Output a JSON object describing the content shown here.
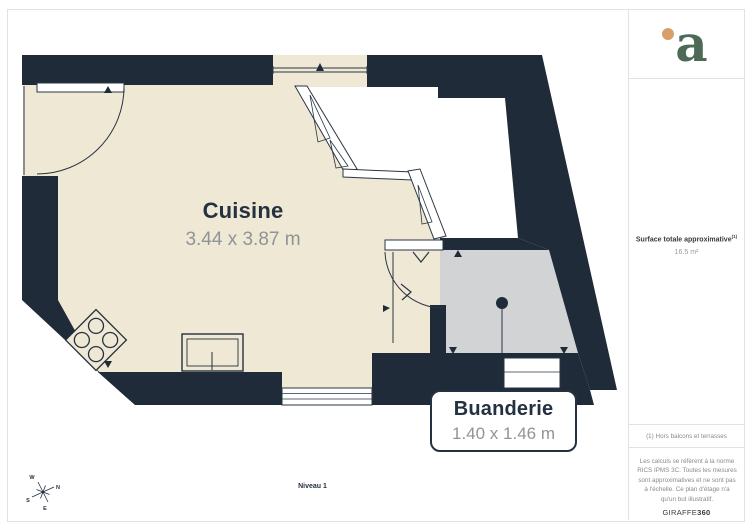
{
  "plan": {
    "rooms": [
      {
        "name": "Cuisine",
        "dimensions": "3.44 x 3.87 m"
      },
      {
        "name": "Buanderie",
        "dimensions": "1.40 x 1.46 m"
      }
    ],
    "level_label": "Niveau 1",
    "compass": {
      "north": "N",
      "south": "S",
      "east": "E",
      "west": "W"
    }
  },
  "sidebar": {
    "logo_letter": "a",
    "surface_label": "Surface totale approximative",
    "surface_footnote_marker": "(1)",
    "surface_value": "16.5 m²",
    "footnote": "(1) Hors balcons et terrasses",
    "disclaimer": "Les calculs se réfèrent à la norme RICS IPMS 3C. Toutes les mesures sont approximatives et ne sont pas à l'échelle. Ce plan d'étage n'a qu'un but illustratif.",
    "brand_name": "GIRAFFE",
    "brand_suffix": "360"
  },
  "colors": {
    "wall": "#1f2b38",
    "kitchen_floor": "#efe8d4",
    "laundry_floor": "#d2d3d5",
    "outline": "#2a3644",
    "text_dark": "#243140",
    "text_gray": "#8f9498",
    "logo_green": "#4d6a57",
    "logo_orange": "#d7a06b",
    "divider": "#e2e2e2"
  }
}
